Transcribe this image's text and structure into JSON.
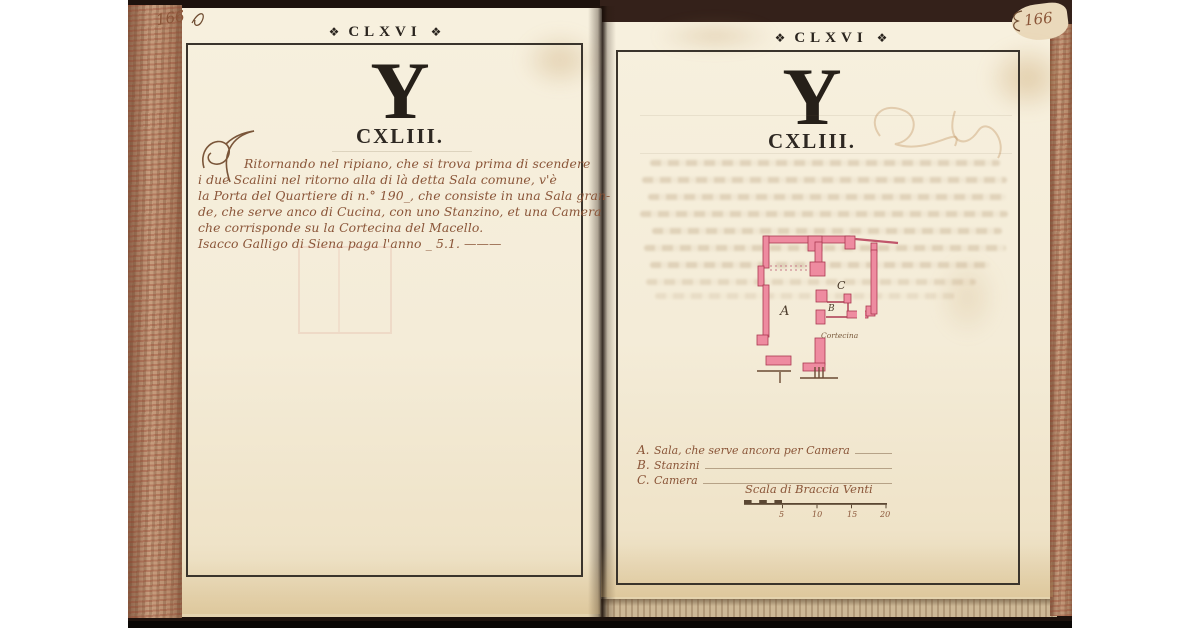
{
  "left_page": {
    "corner_number": "166",
    "header_ornament": "❖",
    "header": "CLXVI",
    "drop_letter": "Y",
    "section_number": "CXLIII.",
    "paragraph": [
      "Ritornando nel ripiano, che si trova prima di scendere",
      "i due Scalini nel ritorno alla di là detta Sala comune, v'è",
      "la Porta del Quartiere di n.° 190_, che consiste in una Sala gran-",
      "de, che serve anco di Cucina, con uno Stanzino, et una Camera",
      "che corrisponde su la Cortecina del Macello.",
      "Isacco Galligo di Siena paga l'anno _ 5.1. ———"
    ]
  },
  "right_page": {
    "corner_number": "166",
    "header_ornament": "❖",
    "header": "CLXVI",
    "drop_letter": "Y",
    "section_number": "CXLIII.",
    "plan": {
      "label_a": "A",
      "label_b": "B",
      "label_c": "C",
      "annotation": "Cortecina"
    },
    "legend": [
      {
        "key": "A.",
        "label": "Sala, che serve ancora per Camera"
      },
      {
        "key": "B.",
        "label": "Stanzini"
      },
      {
        "key": "C.",
        "label": "Camera"
      }
    ],
    "scale": {
      "caption": "Scala di Braccia Venti",
      "ticks": [
        "5",
        "10",
        "15",
        "20"
      ]
    }
  },
  "colors": {
    "page": "#f4ecd9",
    "ink": "#8a5538",
    "plan_fill": "#ee8ba0",
    "plan_stroke": "#ab3850",
    "frame": "#3a342c",
    "bg_dark": "#1d120d"
  }
}
